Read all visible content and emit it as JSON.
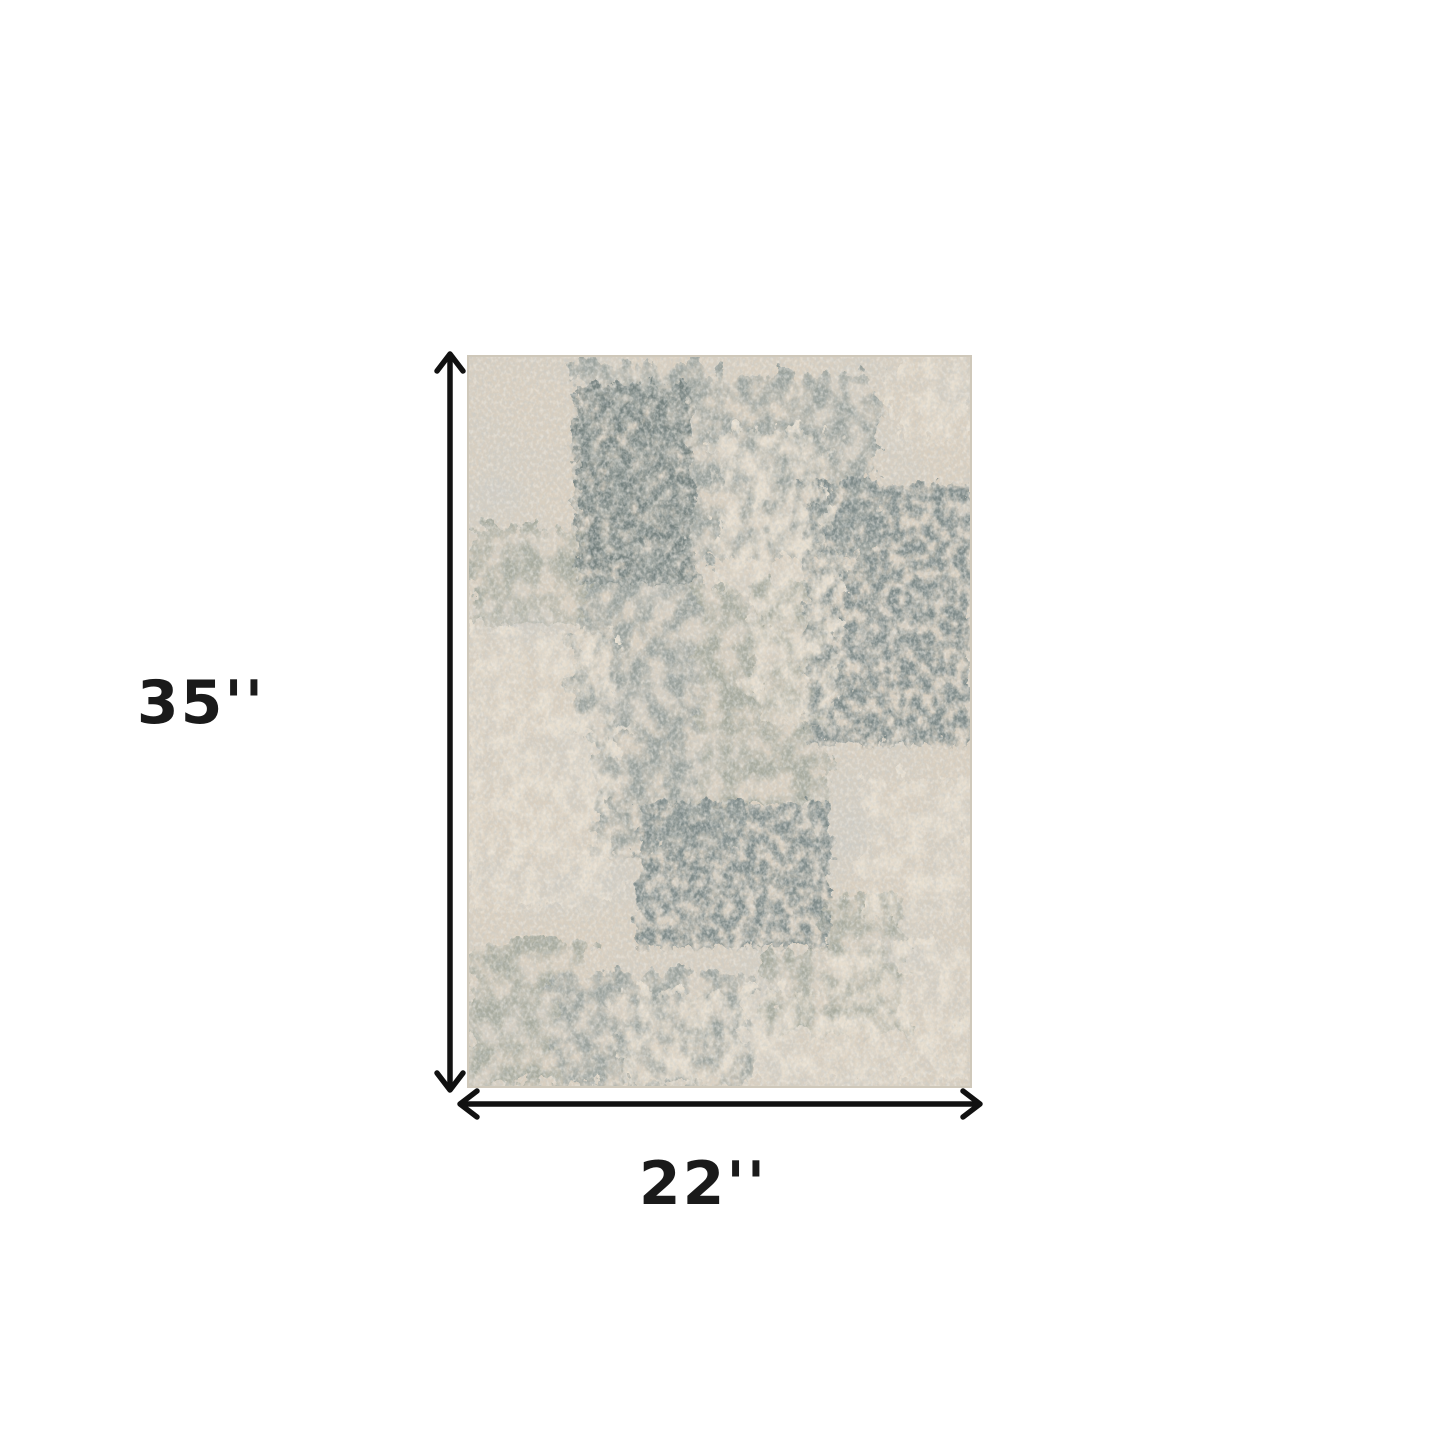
{
  "diagram": {
    "height_label": "35''",
    "width_label": "22''"
  },
  "icons": {
    "height_arrow": "double-headed-vertical-arrow",
    "width_arrow": "double-headed-horizontal-arrow"
  },
  "colors": {
    "page-bg": "#ffffff",
    "arrow": "#111111",
    "label": "#1a1a1a",
    "rug-beige": "#d9cfc0",
    "rug-gray": "#9aa19c",
    "rug-slate": "#7e8a89",
    "rug-cream": "#e7decf"
  }
}
